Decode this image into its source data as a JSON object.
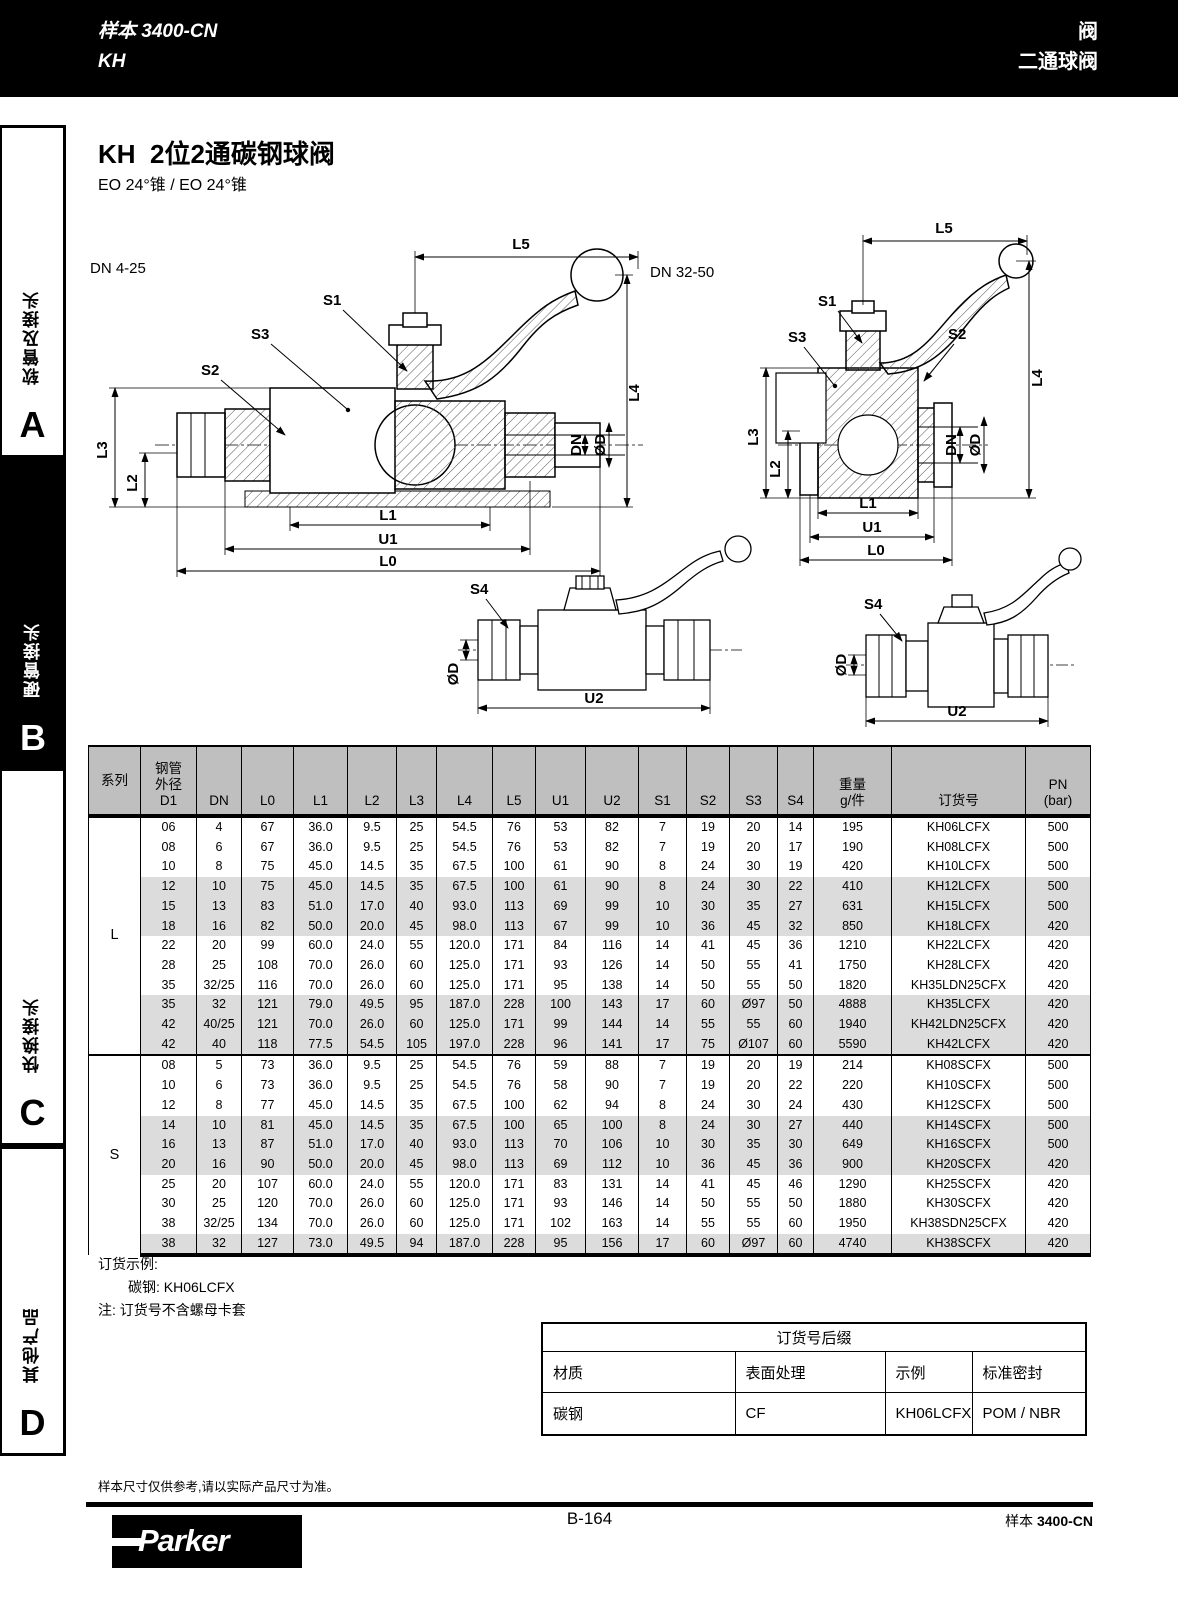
{
  "topbar": {
    "catalog_line1": "样本 3400-CN",
    "catalog_line2": "KH",
    "right_line1": "阀",
    "right_line2": "二通球阀"
  },
  "sidebar": [
    {
      "label": "软管及接头",
      "letter": "A"
    },
    {
      "label": "硬管接头",
      "letter": "B"
    },
    {
      "label": "快换接头",
      "letter": "C"
    },
    {
      "label": "其他产品",
      "letter": "D"
    }
  ],
  "title": "KH  2位2通碳钢球阀",
  "subtitle": "EO 24°锥 / EO 24°锥",
  "drawings": {
    "left_caption": "DN 4-25",
    "right_caption": "DN 32-50",
    "labels": {
      "L5": "L5",
      "L4": "L4",
      "L3": "L3",
      "L2": "L2",
      "L1": "L1",
      "L0": "L0",
      "U1": "U1",
      "U2": "U2",
      "S1": "S1",
      "S2": "S2",
      "S3": "S3",
      "S4": "S4",
      "DN": "DN",
      "OD": "ØD"
    }
  },
  "table": {
    "headers": [
      "系列",
      "钢管\n外径\nD1",
      "DN",
      "L0",
      "L1",
      "L2",
      "L3",
      "L4",
      "L5",
      "U1",
      "U2",
      "S1",
      "S2",
      "S3",
      "S4",
      "重量\ng/件",
      "订货号",
      "PN\n(bar)"
    ],
    "series": [
      {
        "name": "L",
        "rows": [
          [
            "06",
            "4",
            "67",
            "36.0",
            "9.5",
            "25",
            "54.5",
            "76",
            "53",
            "82",
            "7",
            "19",
            "20",
            "14",
            "195",
            "KH06LCFX",
            "500"
          ],
          [
            "08",
            "6",
            "67",
            "36.0",
            "9.5",
            "25",
            "54.5",
            "76",
            "53",
            "82",
            "7",
            "19",
            "20",
            "17",
            "190",
            "KH08LCFX",
            "500"
          ],
          [
            "10",
            "8",
            "75",
            "45.0",
            "14.5",
            "35",
            "67.5",
            "100",
            "61",
            "90",
            "8",
            "24",
            "30",
            "19",
            "420",
            "KH10LCFX",
            "500"
          ],
          [
            "12",
            "10",
            "75",
            "45.0",
            "14.5",
            "35",
            "67.5",
            "100",
            "61",
            "90",
            "8",
            "24",
            "30",
            "22",
            "410",
            "KH12LCFX",
            "500"
          ],
          [
            "15",
            "13",
            "83",
            "51.0",
            "17.0",
            "40",
            "93.0",
            "113",
            "69",
            "99",
            "10",
            "30",
            "35",
            "27",
            "631",
            "KH15LCFX",
            "500"
          ],
          [
            "18",
            "16",
            "82",
            "50.0",
            "20.0",
            "45",
            "98.0",
            "113",
            "67",
            "99",
            "10",
            "36",
            "45",
            "32",
            "850",
            "KH18LCFX",
            "420"
          ],
          [
            "22",
            "20",
            "99",
            "60.0",
            "24.0",
            "55",
            "120.0",
            "171",
            "84",
            "116",
            "14",
            "41",
            "45",
            "36",
            "1210",
            "KH22LCFX",
            "420"
          ],
          [
            "28",
            "25",
            "108",
            "70.0",
            "26.0",
            "60",
            "125.0",
            "171",
            "93",
            "126",
            "14",
            "50",
            "55",
            "41",
            "1750",
            "KH28LCFX",
            "420"
          ],
          [
            "35",
            "32/25",
            "116",
            "70.0",
            "26.0",
            "60",
            "125.0",
            "171",
            "95",
            "138",
            "14",
            "50",
            "55",
            "50",
            "1820",
            "KH35LDN25CFX",
            "420"
          ],
          [
            "35",
            "32",
            "121",
            "79.0",
            "49.5",
            "95",
            "187.0",
            "228",
            "100",
            "143",
            "17",
            "60",
            "Ø97",
            "50",
            "4888",
            "KH35LCFX",
            "420"
          ],
          [
            "42",
            "40/25",
            "121",
            "70.0",
            "26.0",
            "60",
            "125.0",
            "171",
            "99",
            "144",
            "14",
            "55",
            "55",
            "60",
            "1940",
            "KH42LDN25CFX",
            "420"
          ],
          [
            "42",
            "40",
            "118",
            "77.5",
            "54.5",
            "105",
            "197.0",
            "228",
            "96",
            "141",
            "17",
            "75",
            "Ø107",
            "60",
            "5590",
            "KH42LCFX",
            "420"
          ]
        ]
      },
      {
        "name": "S",
        "rows": [
          [
            "08",
            "5",
            "73",
            "36.0",
            "9.5",
            "25",
            "54.5",
            "76",
            "59",
            "88",
            "7",
            "19",
            "20",
            "19",
            "214",
            "KH08SCFX",
            "500"
          ],
          [
            "10",
            "6",
            "73",
            "36.0",
            "9.5",
            "25",
            "54.5",
            "76",
            "58",
            "90",
            "7",
            "19",
            "20",
            "22",
            "220",
            "KH10SCFX",
            "500"
          ],
          [
            "12",
            "8",
            "77",
            "45.0",
            "14.5",
            "35",
            "67.5",
            "100",
            "62",
            "94",
            "8",
            "24",
            "30",
            "24",
            "430",
            "KH12SCFX",
            "500"
          ],
          [
            "14",
            "10",
            "81",
            "45.0",
            "14.5",
            "35",
            "67.5",
            "100",
            "65",
            "100",
            "8",
            "24",
            "30",
            "27",
            "440",
            "KH14SCFX",
            "500"
          ],
          [
            "16",
            "13",
            "87",
            "51.0",
            "17.0",
            "40",
            "93.0",
            "113",
            "70",
            "106",
            "10",
            "30",
            "35",
            "30",
            "649",
            "KH16SCFX",
            "500"
          ],
          [
            "20",
            "16",
            "90",
            "50.0",
            "20.0",
            "45",
            "98.0",
            "113",
            "69",
            "112",
            "10",
            "36",
            "45",
            "36",
            "900",
            "KH20SCFX",
            "420"
          ],
          [
            "25",
            "20",
            "107",
            "60.0",
            "24.0",
            "55",
            "120.0",
            "171",
            "83",
            "131",
            "14",
            "41",
            "45",
            "46",
            "1290",
            "KH25SCFX",
            "420"
          ],
          [
            "30",
            "25",
            "120",
            "70.0",
            "26.0",
            "60",
            "125.0",
            "171",
            "93",
            "146",
            "14",
            "50",
            "55",
            "50",
            "1880",
            "KH30SCFX",
            "420"
          ],
          [
            "38",
            "32/25",
            "134",
            "70.0",
            "26.0",
            "60",
            "125.0",
            "171",
            "102",
            "163",
            "14",
            "55",
            "55",
            "60",
            "1950",
            "KH38SDN25CFX",
            "420"
          ],
          [
            "38",
            "32",
            "127",
            "73.0",
            "49.5",
            "94",
            "187.0",
            "228",
            "95",
            "156",
            "17",
            "60",
            "Ø97",
            "60",
            "4740",
            "KH38SCFX",
            "420"
          ]
        ]
      }
    ]
  },
  "order_example": {
    "line1": "订货示例:",
    "line2_label": "碳钢:",
    "line2_value": "KH06LCFX",
    "line3": "注: 订货号不含螺母卡套"
  },
  "suffix_table": {
    "title": "订货号后缀",
    "headers": [
      "材质",
      "表面处理",
      "示例",
      "标准密封"
    ],
    "rows": [
      [
        "碳钢",
        "CF",
        "KH06LCFX",
        "POM / NBR"
      ]
    ]
  },
  "footnote": "样本尺寸仅供参考,请以实际产品尺寸为准。",
  "footer": {
    "page": "B-164",
    "catalog_prefix": "样本 ",
    "catalog_code": "3400-CN",
    "logo": "Parker"
  }
}
